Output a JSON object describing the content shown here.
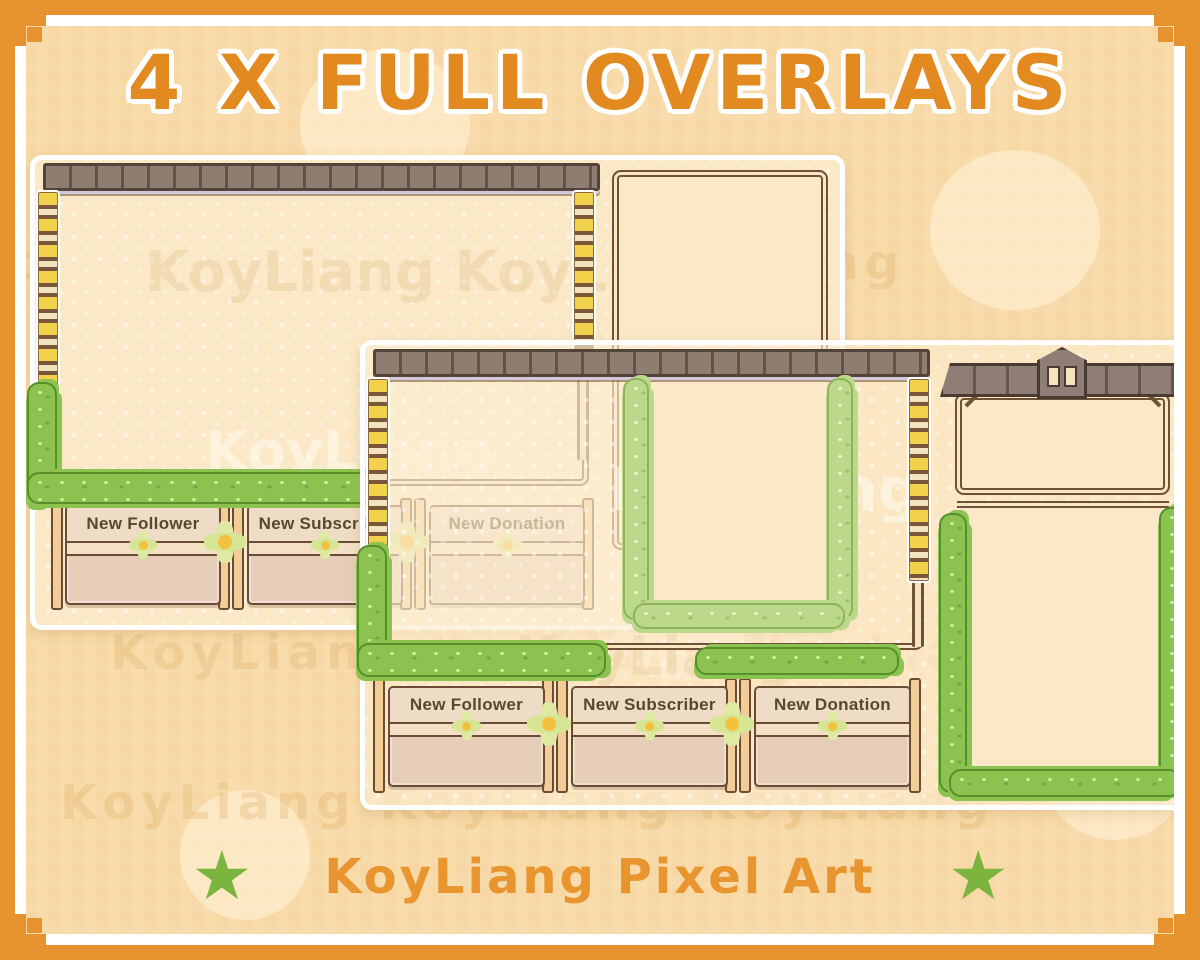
{
  "title": "4 X FULL OVERLAYS",
  "footer": {
    "brand": "KoyLiang Pixel Art",
    "star": "★"
  },
  "watermark": {
    "word": "KoyLiang",
    "pair": "KoyLiang  KoyLiang",
    "row": "KoyLiang    KoyLiang    KoyLiang"
  },
  "overlays": {
    "back": {
      "alerts": [
        {
          "label": "New Follower"
        },
        {
          "label": "New Subscriber"
        },
        {
          "label": "New Donation"
        }
      ]
    },
    "front": {
      "alerts": [
        {
          "label": "New Follower"
        },
        {
          "label": "New Subscriber"
        },
        {
          "label": "New Donation"
        }
      ]
    }
  },
  "colors": {
    "border_orange": "#E5922F",
    "background_peach": "#F9DBA9",
    "title_orange": "#E28A20",
    "brand_orange": "#E8952F",
    "star_green": "#7CB440",
    "vine_green": "#8CC250",
    "vine_light_green": "#BCD98B",
    "wood_dark_brown": "#6F5138",
    "beam_taupe": "#8E7E72",
    "panel_tan": "#E6CDB8",
    "card_cream": "#FBE8C6",
    "flower_yellow": "#F2D24B"
  }
}
